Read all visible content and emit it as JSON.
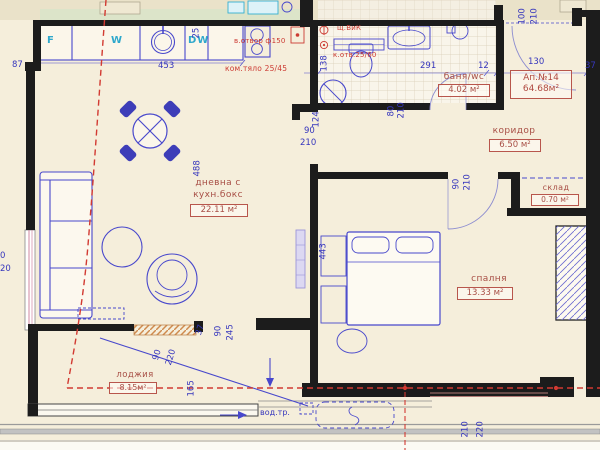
{
  "apartment": {
    "number": "Ап.№14",
    "area": "64.68м²"
  },
  "rooms": {
    "living": {
      "name_line1": "дневна с",
      "name_line2": "кухн.бокс",
      "area": "22.11 м²"
    },
    "bathroom": {
      "name": "баня/wc",
      "area": "4.02 м²"
    },
    "corridor": {
      "name": "коридор",
      "area": "6.50 м²"
    },
    "storage": {
      "name": "склад",
      "area": "0.70 м²"
    },
    "bedroom": {
      "name": "спалня",
      "area": "13.33 м²"
    },
    "loggia": {
      "name": "лоджия",
      "area": "8.15м²"
    }
  },
  "appliances": {
    "fridge": "F",
    "washing_machine": "W",
    "dishwasher": "DW"
  },
  "annotations": {
    "vent_opening": "в.отвор ф150",
    "chimney": "ком.тяло 25/45",
    "riser": "щ.ВиК",
    "duct": "к.отв.25/60",
    "water_pipe": "вод.тр."
  },
  "dimensions": {
    "left_step": "87",
    "counter_width": "453",
    "counter_depth": "25",
    "living_height": "488",
    "bath_left": "138",
    "wall_seg": "124",
    "living_door_w": "90",
    "living_door_h": "210",
    "bath_door_w": "80",
    "bath_door_h": "210",
    "bath_width": "291",
    "wall_12": "12",
    "entry_width": "130",
    "right_edge": "37",
    "entry_door_w": "100",
    "entry_door_h": "210",
    "bed_door_w": "90",
    "bed_door_h": "210",
    "bed_wall": "443",
    "loggia_door_w": "90",
    "loggia_door_h": "220",
    "diag_165": "165",
    "sill_37": "37",
    "window_w": "90",
    "window_h": "245",
    "bottom_210": "210",
    "bottom_220": "220",
    "left_cut_0": "0",
    "left_cut_20": "20"
  },
  "colors": {
    "wall": "#1c1c1c",
    "furniture_blue": "#4848cc",
    "label_red": "#b8564c",
    "appliance_cyan": "#2fa8cc",
    "dashed_red": "#d23a32",
    "sill_orange": "#cf8a4e"
  }
}
